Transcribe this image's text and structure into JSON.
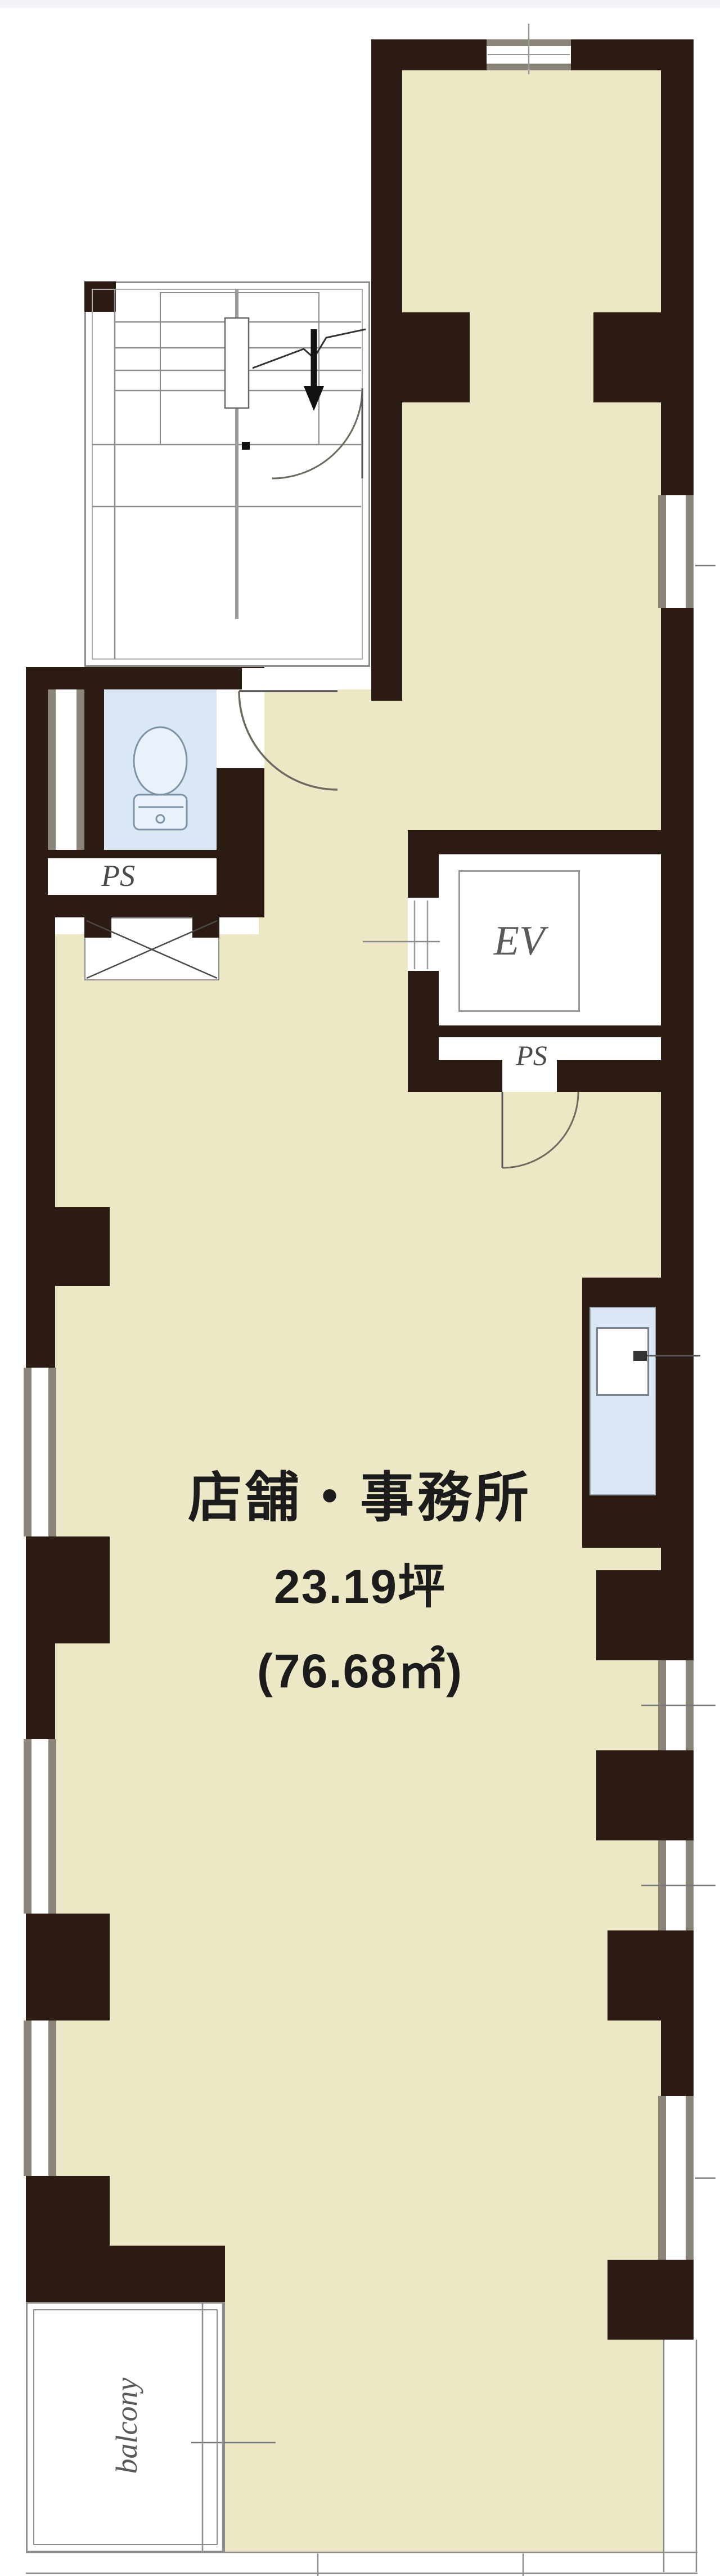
{
  "plan": {
    "room_label": "店舗・事務所",
    "area_tsubo": "23.19坪",
    "area_sqm": "(76.68㎡)",
    "elevator_label": "EV",
    "pipe_space_label_toilet": "PS",
    "pipe_space_label_elevator": "PS",
    "balcony_label": "balcony"
  },
  "colors": {
    "wall": "#2b1b12",
    "floor": "#ece7c4",
    "fixture": "#d9e8f4",
    "frame": "#8a8578",
    "line": "#8a8a8a",
    "door": "#6f6a60",
    "text": "#1c1c1c",
    "label": "#4a4a4a"
  }
}
